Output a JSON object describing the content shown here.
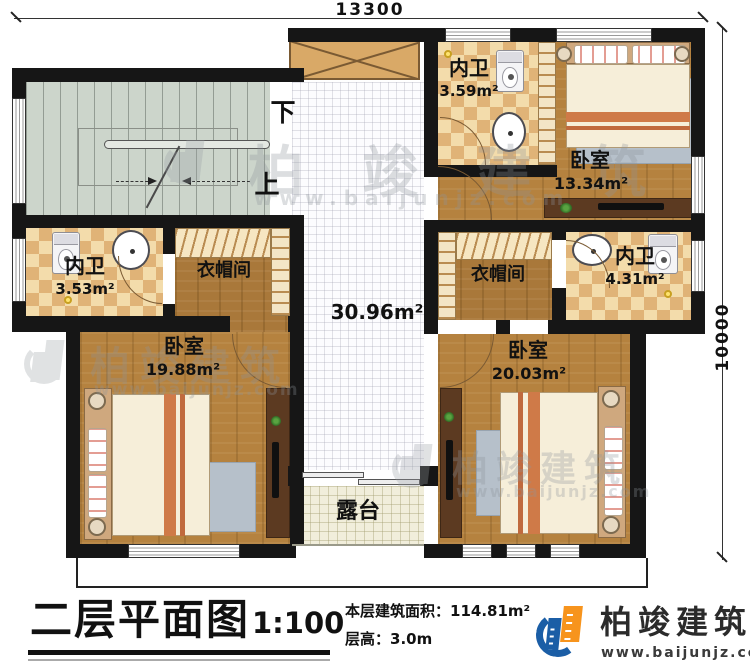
{
  "dimensions": {
    "width": "13300",
    "height": "10000"
  },
  "rooms": {
    "bath_top": {
      "label": "内卫",
      "area": "3.59m²"
    },
    "bedroom_top_right": {
      "label": "卧室",
      "area": "13.34m²"
    },
    "bath_left": {
      "label": "内卫",
      "area": "3.53m²"
    },
    "closet_left": {
      "label": "衣帽间"
    },
    "hall": {
      "area": "30.96m²"
    },
    "closet_right": {
      "label": "衣帽间"
    },
    "bath_right": {
      "label": "内卫",
      "area": "4.31m²"
    },
    "bedroom_bottom_left": {
      "label": "卧室",
      "area": "19.88m²"
    },
    "bedroom_bottom_right": {
      "label": "卧室",
      "area": "20.03m²"
    },
    "terrace": {
      "label": "露台"
    }
  },
  "stairs": {
    "down": "下",
    "up": "上"
  },
  "title_block": {
    "title": "二层平面图",
    "scale": "1:100",
    "area_label": "本层建筑面积：",
    "area_value": "114.81m²",
    "height_label": "层高：",
    "height_value": "3.0m"
  },
  "brand": {
    "name": "柏竣建筑",
    "website": "www.baijunjz.com"
  },
  "watermark": {
    "name": "柏竣建筑",
    "website": "www.baijunjz.com"
  },
  "colors": {
    "wall": "#161616",
    "wood": "#b5823f",
    "wood_dark": "#a9783a",
    "checker_light": "#f3dcab",
    "checker_dark": "#e0b377",
    "stairs": "#ccd5cb",
    "hall": "#fcfcfe",
    "terrace": "#f1eedb",
    "brand_blue": "#1b5ea6",
    "brand_orange": "#f7941d"
  }
}
